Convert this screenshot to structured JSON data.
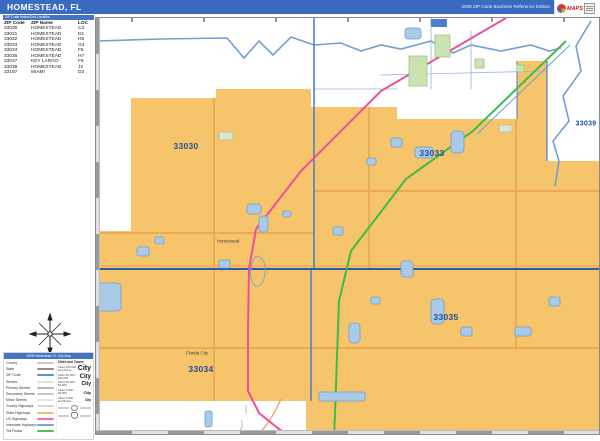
{
  "title_bar": {
    "title": "HOMESTEAD, FL",
    "edition": "2008 ZIP Code Business Reference Edition",
    "logo_text": "MAPS"
  },
  "zip_table": {
    "header_bar": "ZIP Code Index/Grid Location",
    "columns": [
      "ZIP Code",
      "ZIP Name",
      "LOC"
    ],
    "rows": [
      [
        "33030",
        "HOMESTEAD",
        "C3"
      ],
      [
        "33031",
        "HOMESTEAD",
        "D1"
      ],
      [
        "33032",
        "HOMESTEAD",
        "H5"
      ],
      [
        "33033",
        "HOMESTEAD",
        "G4"
      ],
      [
        "33034",
        "HOMESTEAD",
        "F5"
      ],
      [
        "33035",
        "HOMESTEAD",
        "H7"
      ],
      [
        "33037",
        "KEY LARGO",
        "F9"
      ],
      [
        "33039",
        "HOMESTEAD",
        "J2"
      ],
      [
        "33187",
        "MIAMI",
        "D3"
      ]
    ]
  },
  "map": {
    "zip_labels": [
      {
        "text": "33030",
        "x": 185,
        "y": 145,
        "size": 8.5
      },
      {
        "text": "33033",
        "x": 431,
        "y": 152,
        "size": 8.5
      },
      {
        "text": "33039",
        "x": 585,
        "y": 123,
        "size": 7
      },
      {
        "text": "33035",
        "x": 445,
        "y": 316,
        "size": 8.5
      },
      {
        "text": "33034",
        "x": 200,
        "y": 368,
        "size": 8.5
      }
    ],
    "city_labels": [
      {
        "text": "Homestead",
        "x": 227,
        "y": 240
      },
      {
        "text": "Florida City",
        "x": 196,
        "y": 352
      }
    ]
  },
  "legend": {
    "header": "2008 Homestead, FL City Map",
    "line_items": [
      {
        "label": "County",
        "color": "#c9c9c9"
      },
      {
        "label": "State",
        "color": "#8f8f8f"
      },
      {
        "label": "ZIP Code",
        "color": "#5b8fd0"
      },
      {
        "label": "Streets",
        "color": "#e0e0e0"
      },
      {
        "label": "Primary Streets",
        "color": "#b5b5b5"
      },
      {
        "label": "Secondary Streets",
        "color": "#c9c9c9"
      },
      {
        "label": "Minor Streets",
        "color": "#e4e4e4"
      },
      {
        "label": "County Highways",
        "color": "#d8d8d8"
      },
      {
        "label": "State Highways",
        "color": "#f0c060"
      },
      {
        "label": "US Highways",
        "color": "#ee6fae"
      },
      {
        "label": "Interstate Highways",
        "color": "#7aa6e0"
      },
      {
        "label": "Toll Roads",
        "color": "#4fc24f"
      }
    ],
    "cities_header": "Cities and Towns",
    "city_classes": [
      {
        "label": "Cities 100,000 and Above",
        "sample": "City"
      },
      {
        "label": "Cities 50,000 - 100,000",
        "sample": "City"
      },
      {
        "label": "Cities 25,000 - 50,000",
        "sample": "City"
      },
      {
        "label": "Cities 5,000 - 25,000",
        "sample": "City"
      },
      {
        "label": "Cities 5,000 and Below",
        "sample": "City"
      }
    ]
  },
  "colors": {
    "title_bar_blue": "#3a6bc1",
    "table_header_blue": "#4472c4",
    "zip_fill_orange": "#f5c46b",
    "zip_boundary_blue": "#4a7cc7",
    "major_boundary_blue": "#2b5ba8",
    "water_fill": "#a9cbe8",
    "water_stroke": "#6f9fd4",
    "park_green": "#cbe3b0",
    "toll_road_green": "#3fbb4a",
    "us_highway_pink": "#ee4e9e",
    "state_road_orange": "#e8a050",
    "zip_label_blue": "#1f4e9c"
  }
}
